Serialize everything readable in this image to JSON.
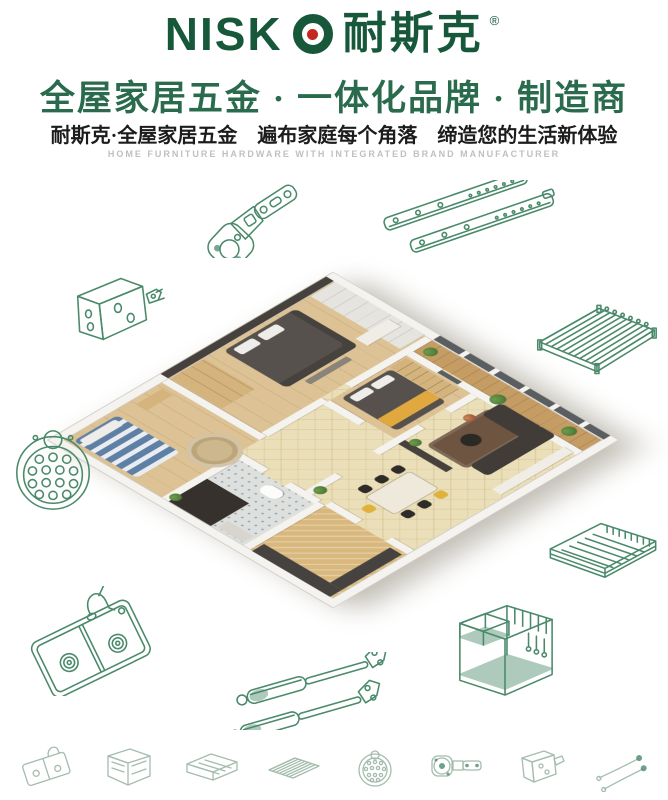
{
  "brand": {
    "logo_latin_prefix": "NISK",
    "logo_o_icon": "ring-with-red-dot",
    "logo_latin_full": "NISKO",
    "logo_zh": "耐斯克",
    "registered_mark": "®"
  },
  "header": {
    "headline": "全屋家居五金 · 一体化品牌 · 制造商",
    "subheadline": "耐斯克·全屋家居五金　遍布家庭每个角落　缔造您的生活新体验",
    "tagline_en": "HOME FURNITURE HARDWARE WITH INTEGRATED BRAND MANUFACTURER"
  },
  "palette": {
    "paper": "#ffffff",
    "brand_green": "#17583b",
    "headline_green": "#2a6a4d",
    "logo_red": "#c3271d",
    "text_dark": "#1c1c1c",
    "tagline_gray": "#c0c0c0",
    "line_green": "#4a8a6b",
    "line_faded": "#a4bcae"
  },
  "apartment_palette": {
    "wall": "#f4f3ef",
    "wall_edge": "#cfccc5",
    "dark_wall": "#46413c",
    "tile_cream": "#eadfb8",
    "tile_line": "rgba(150,118,52,0.16)",
    "wood": "#dcc294",
    "wood_line": "#d0b384",
    "bath_tile": "#dde0dc",
    "bath_dot": "#8f9cb0",
    "shower_dark": "#36312c",
    "kitchen_tile": "#d9b87e",
    "counter_dark": "#454240",
    "balcony_wood": "#c59c63",
    "glass_dark": "#5b5e61",
    "bed_dark": "#56514c",
    "pillow": "#efede9",
    "bed_blue_a": "#5f80a5",
    "bed_blue_b": "#e9edf2",
    "bed_yellow": "#e0a83e",
    "shelf_tan": "#d5b37d",
    "rug_brown": "#6e5541",
    "rug_tan": "#cdb78c",
    "sofa_dark": "#413c37",
    "table_cream": "#efe9dc",
    "chair_dark": "#2e2b28",
    "chair_yellow": "#dfb23c",
    "plant_a": "#4e7a38",
    "plant_b": "#6f9c4c",
    "white_furn": "#f0ede6"
  },
  "products_large": [
    "concealed-cabinet-hinge",
    "ball-bearing-drawer-slides",
    "mounting-bracket",
    "wire-shelf-rack",
    "sink-strainer-plate",
    "pull-out-wire-basket",
    "double-bowl-kitchen-sink",
    "gas-lift-struts",
    "kitchen-wire-organizer-rack"
  ],
  "products_small": [
    "sink-mini",
    "cabinet-organizer-mini",
    "wire-basket-mini",
    "wire-shelf-mini",
    "strainer-mini",
    "hinge-mini",
    "bracket-mini",
    "gas-strut-mini"
  ]
}
